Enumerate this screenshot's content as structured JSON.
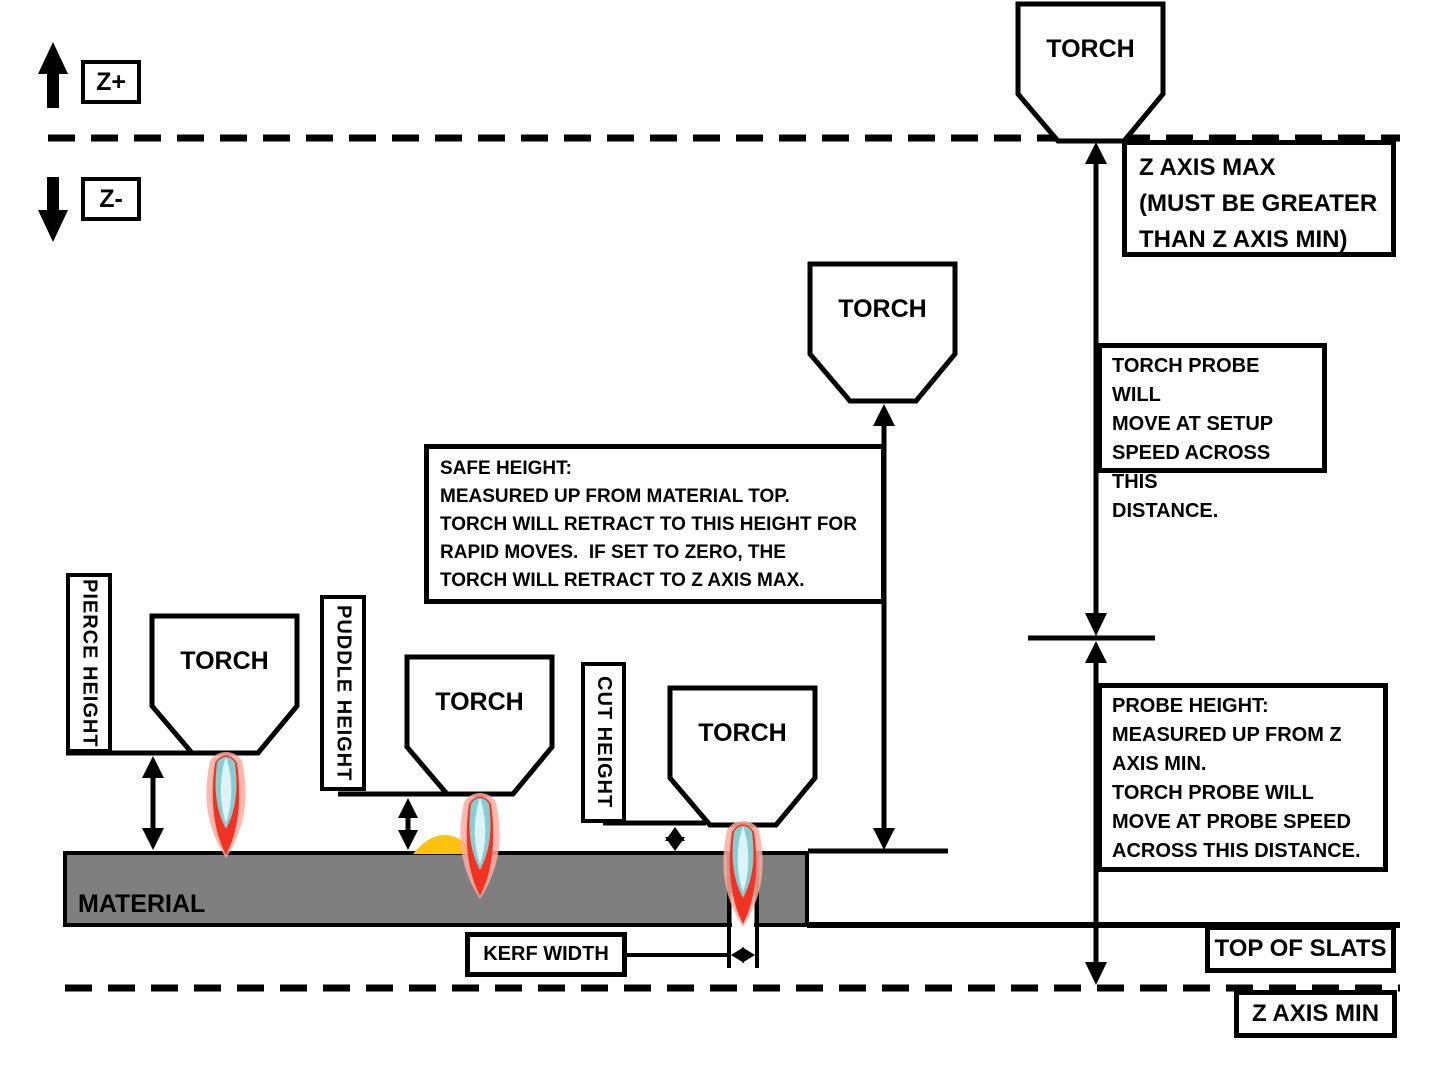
{
  "axis": {
    "z_plus": "Z+",
    "z_minus": "Z-"
  },
  "torch_label": "TORCH",
  "material_label": "MATERIAL",
  "measurement_labels": {
    "pierce_height": "PIERCE HEIGHT",
    "puddle_height": "PUDDLE HEIGHT",
    "cut_height": "CUT HEIGHT",
    "kerf_width": "KERF WIDTH"
  },
  "callouts": {
    "safe_height": "SAFE HEIGHT:\nMEASURED UP FROM MATERIAL TOP.\nTORCH WILL RETRACT TO THIS HEIGHT FOR\nRAPID MOVES.  IF SET TO ZERO, THE\nTORCH WILL RETRACT TO Z AXIS MAX.",
    "z_axis_max": "Z AXIS MAX\n(MUST BE GREATER\nTHAN Z AXIS MIN)",
    "setup_speed": "TORCH PROBE WILL\nMOVE AT SETUP\nSPEED ACROSS THIS\nDISTANCE.",
    "probe_height": "PROBE HEIGHT:\nMEASURED UP FROM Z\nAXIS MIN.\nTORCH PROBE WILL\nMOVE AT PROBE SPEED\nACROSS THIS DISTANCE.",
    "top_of_slats": "TOP OF SLATS",
    "z_axis_min": "Z AXIS MIN"
  },
  "colors": {
    "stroke": "#000000",
    "material_gray": "#7f7f7f",
    "puddle_orange": "#fec10d",
    "flame_red": "#f23222",
    "flame_glow": "#fbab9f",
    "flame_teal": "#85ced2",
    "flame_core": "#dcf4f9"
  }
}
